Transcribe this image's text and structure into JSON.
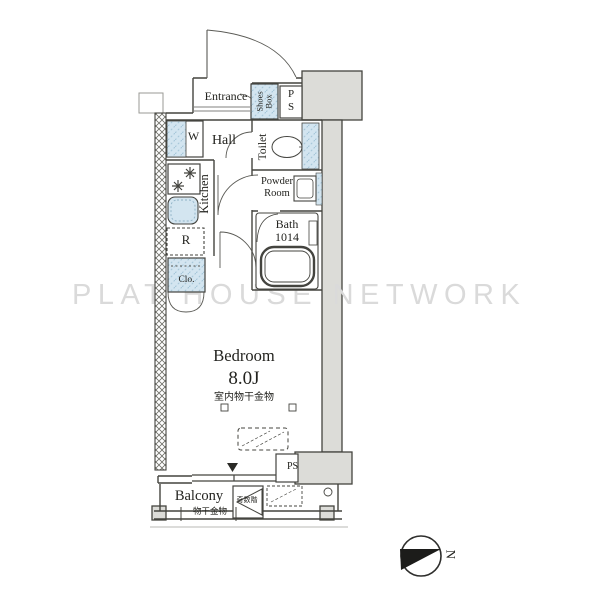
{
  "watermark": "PLAT HOUSE NETWORK",
  "compass": {
    "north_label": "N"
  },
  "rooms": {
    "entrance": {
      "label": "Entrance"
    },
    "shoes_box": {
      "label": "Shoes Box"
    },
    "pipe_space_upper": {
      "label": "PS"
    },
    "hall": {
      "label": "Hall"
    },
    "toilet": {
      "label": "Toilet"
    },
    "powder_room": {
      "label": "Powder Room"
    },
    "bath": {
      "label": "Bath",
      "size": "1014"
    },
    "kitchen": {
      "label": "Kitchen"
    },
    "bedroom": {
      "label": "Bedroom",
      "size": "8.0J",
      "fitting_note": "室内物干金物"
    },
    "balcony": {
      "label": "Balcony",
      "fitting_note": "物干金物"
    },
    "pipe_space_lower": {
      "label": "PS"
    }
  },
  "fixtures": {
    "washer": {
      "label": "W"
    },
    "refrigerator": {
      "label": "R"
    },
    "closet": {
      "label": "Clo."
    },
    "escape_hatch": {
      "label": "奇数階"
    }
  },
  "colors": {
    "fixture_blue": "#d3e5f0",
    "structure_gray": "#dcdcd8",
    "wall_line": "#44443f",
    "watermark_gray": "#dadada"
  }
}
